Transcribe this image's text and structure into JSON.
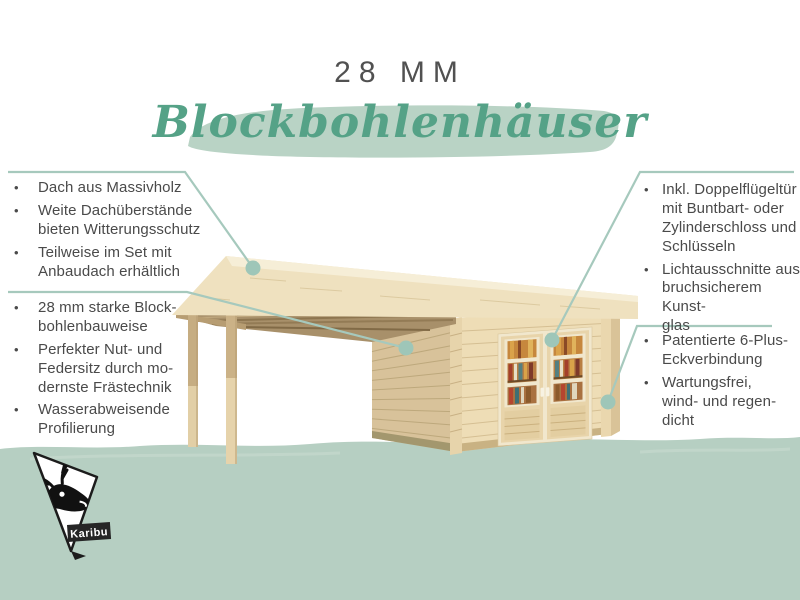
{
  "ui": {
    "bullet": "•"
  },
  "header": {
    "title": "28 MM",
    "heading": "Blockbohlenhäuser"
  },
  "features_left_top": {
    "items": [
      {
        "text": "Dach aus Massivholz"
      },
      {
        "text": "Weite Dachüberstände\nbieten Witterungsschutz"
      },
      {
        "text": "Teilweise im Set mit\nAnbaudach erhältlich"
      }
    ]
  },
  "features_left_bottom": {
    "items": [
      {
        "text": "28 mm starke Block-\nbohlenbauweise"
      },
      {
        "text": "Perfekter Nut- und\nFedersitz durch mo-\ndernste Frästechnik"
      },
      {
        "text": "Wasserabweisende\nProfilierung"
      }
    ]
  },
  "features_right_top": {
    "items": [
      {
        "text": "Inkl. Doppelflügeltür\nmit Buntbart- oder\nZylinderschloss und\nSchlüsseln"
      },
      {
        "text": "Lichtausschnitte aus\nbruchsicherem Kunst-\nglas"
      }
    ]
  },
  "features_right_bottom": {
    "items": [
      {
        "text": "Patentierte 6-Plus-\nEckverbindung"
      },
      {
        "text": "Wartungsfrei,\nwind- und regen-\ndicht"
      }
    ]
  },
  "logo": {
    "brand": "Karibu"
  },
  "colors": {
    "accent_green": "#57a287",
    "brush_green": "#b9d3c5",
    "ground_green": "#b6cfc2",
    "callout_teal": "#a6c9bd",
    "text_gray": "#4a4a4a",
    "wood_front": "#eeddb6",
    "wood_shadow": "#d8c29a",
    "roof_cream": "#efe1bf"
  }
}
